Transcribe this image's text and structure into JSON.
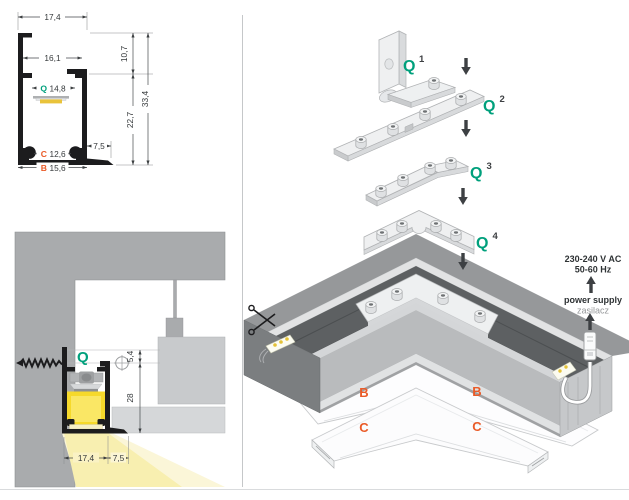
{
  "colors": {
    "green": "#00A07C",
    "orange": "#EA5B28"
  },
  "cross_section": {
    "label_q": "Q",
    "label_c": "C",
    "label_b": "B",
    "dim_top_width": "17,4",
    "dim_inner_width": "16,1",
    "dim_q_slot": "14,8",
    "dim_upper_height": "10,7",
    "dim_total_height": "33,4",
    "dim_lower_height": "22,7",
    "dim_flange": "7,5",
    "dim_c": "12,6",
    "dim_b": "15,6"
  },
  "installation": {
    "label_q": "Q",
    "dim_offset": "5,4",
    "dim_recess": "28",
    "dim_width": "17,4",
    "dim_gap": "7,5"
  },
  "assembly": {
    "parts": [
      {
        "label": "Q",
        "sup": "1"
      },
      {
        "label": "Q",
        "sup": "2"
      },
      {
        "label": "Q",
        "sup": "3"
      },
      {
        "label": "Q",
        "sup": "4"
      }
    ],
    "cover_b": "B",
    "cover_c": "C",
    "power": {
      "line1": "230-240 V AC",
      "line2": "50-60 Hz",
      "label": "power supply",
      "label_pl": "zasilacz"
    }
  }
}
